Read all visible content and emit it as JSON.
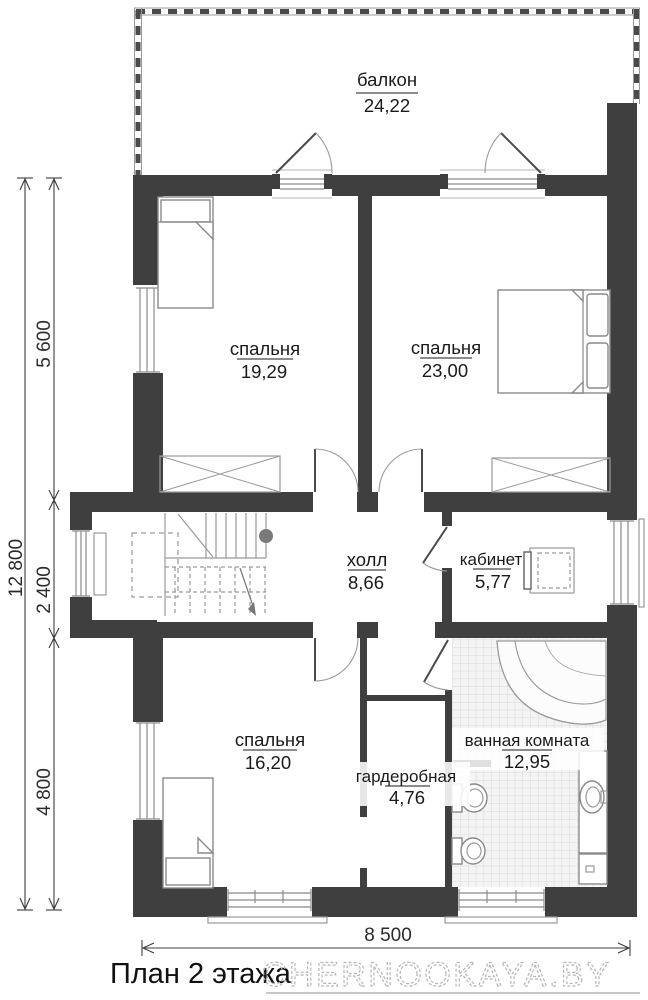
{
  "plan": {
    "footer": {
      "title": "План 2 этажа",
      "watermark": "CHERNOOKAYA.BY"
    },
    "rooms": [
      {
        "name": "балкон",
        "area": "24,22"
      },
      {
        "name": "спальня",
        "area": "19,29"
      },
      {
        "name": "спальня",
        "area": "23,00"
      },
      {
        "name": "холл",
        "area": "8,66"
      },
      {
        "name": "кабинет",
        "area": "5,77"
      },
      {
        "name": "спальня",
        "area": "16,20"
      },
      {
        "name": "гардеробная",
        "area": "4,76"
      },
      {
        "name": "ванная комната",
        "area": "12,95"
      }
    ],
    "dimensions": {
      "height_total": "12 800",
      "height_upper": "5 600",
      "height_middle": "2 400",
      "height_lower": "4 800",
      "width_bottom": "8 500"
    },
    "colors": {
      "wall": "#3f3f3f",
      "furniture_line": "#8a8a8a",
      "text": "#1a1a1a",
      "watermark": "#b6b6b6"
    }
  }
}
